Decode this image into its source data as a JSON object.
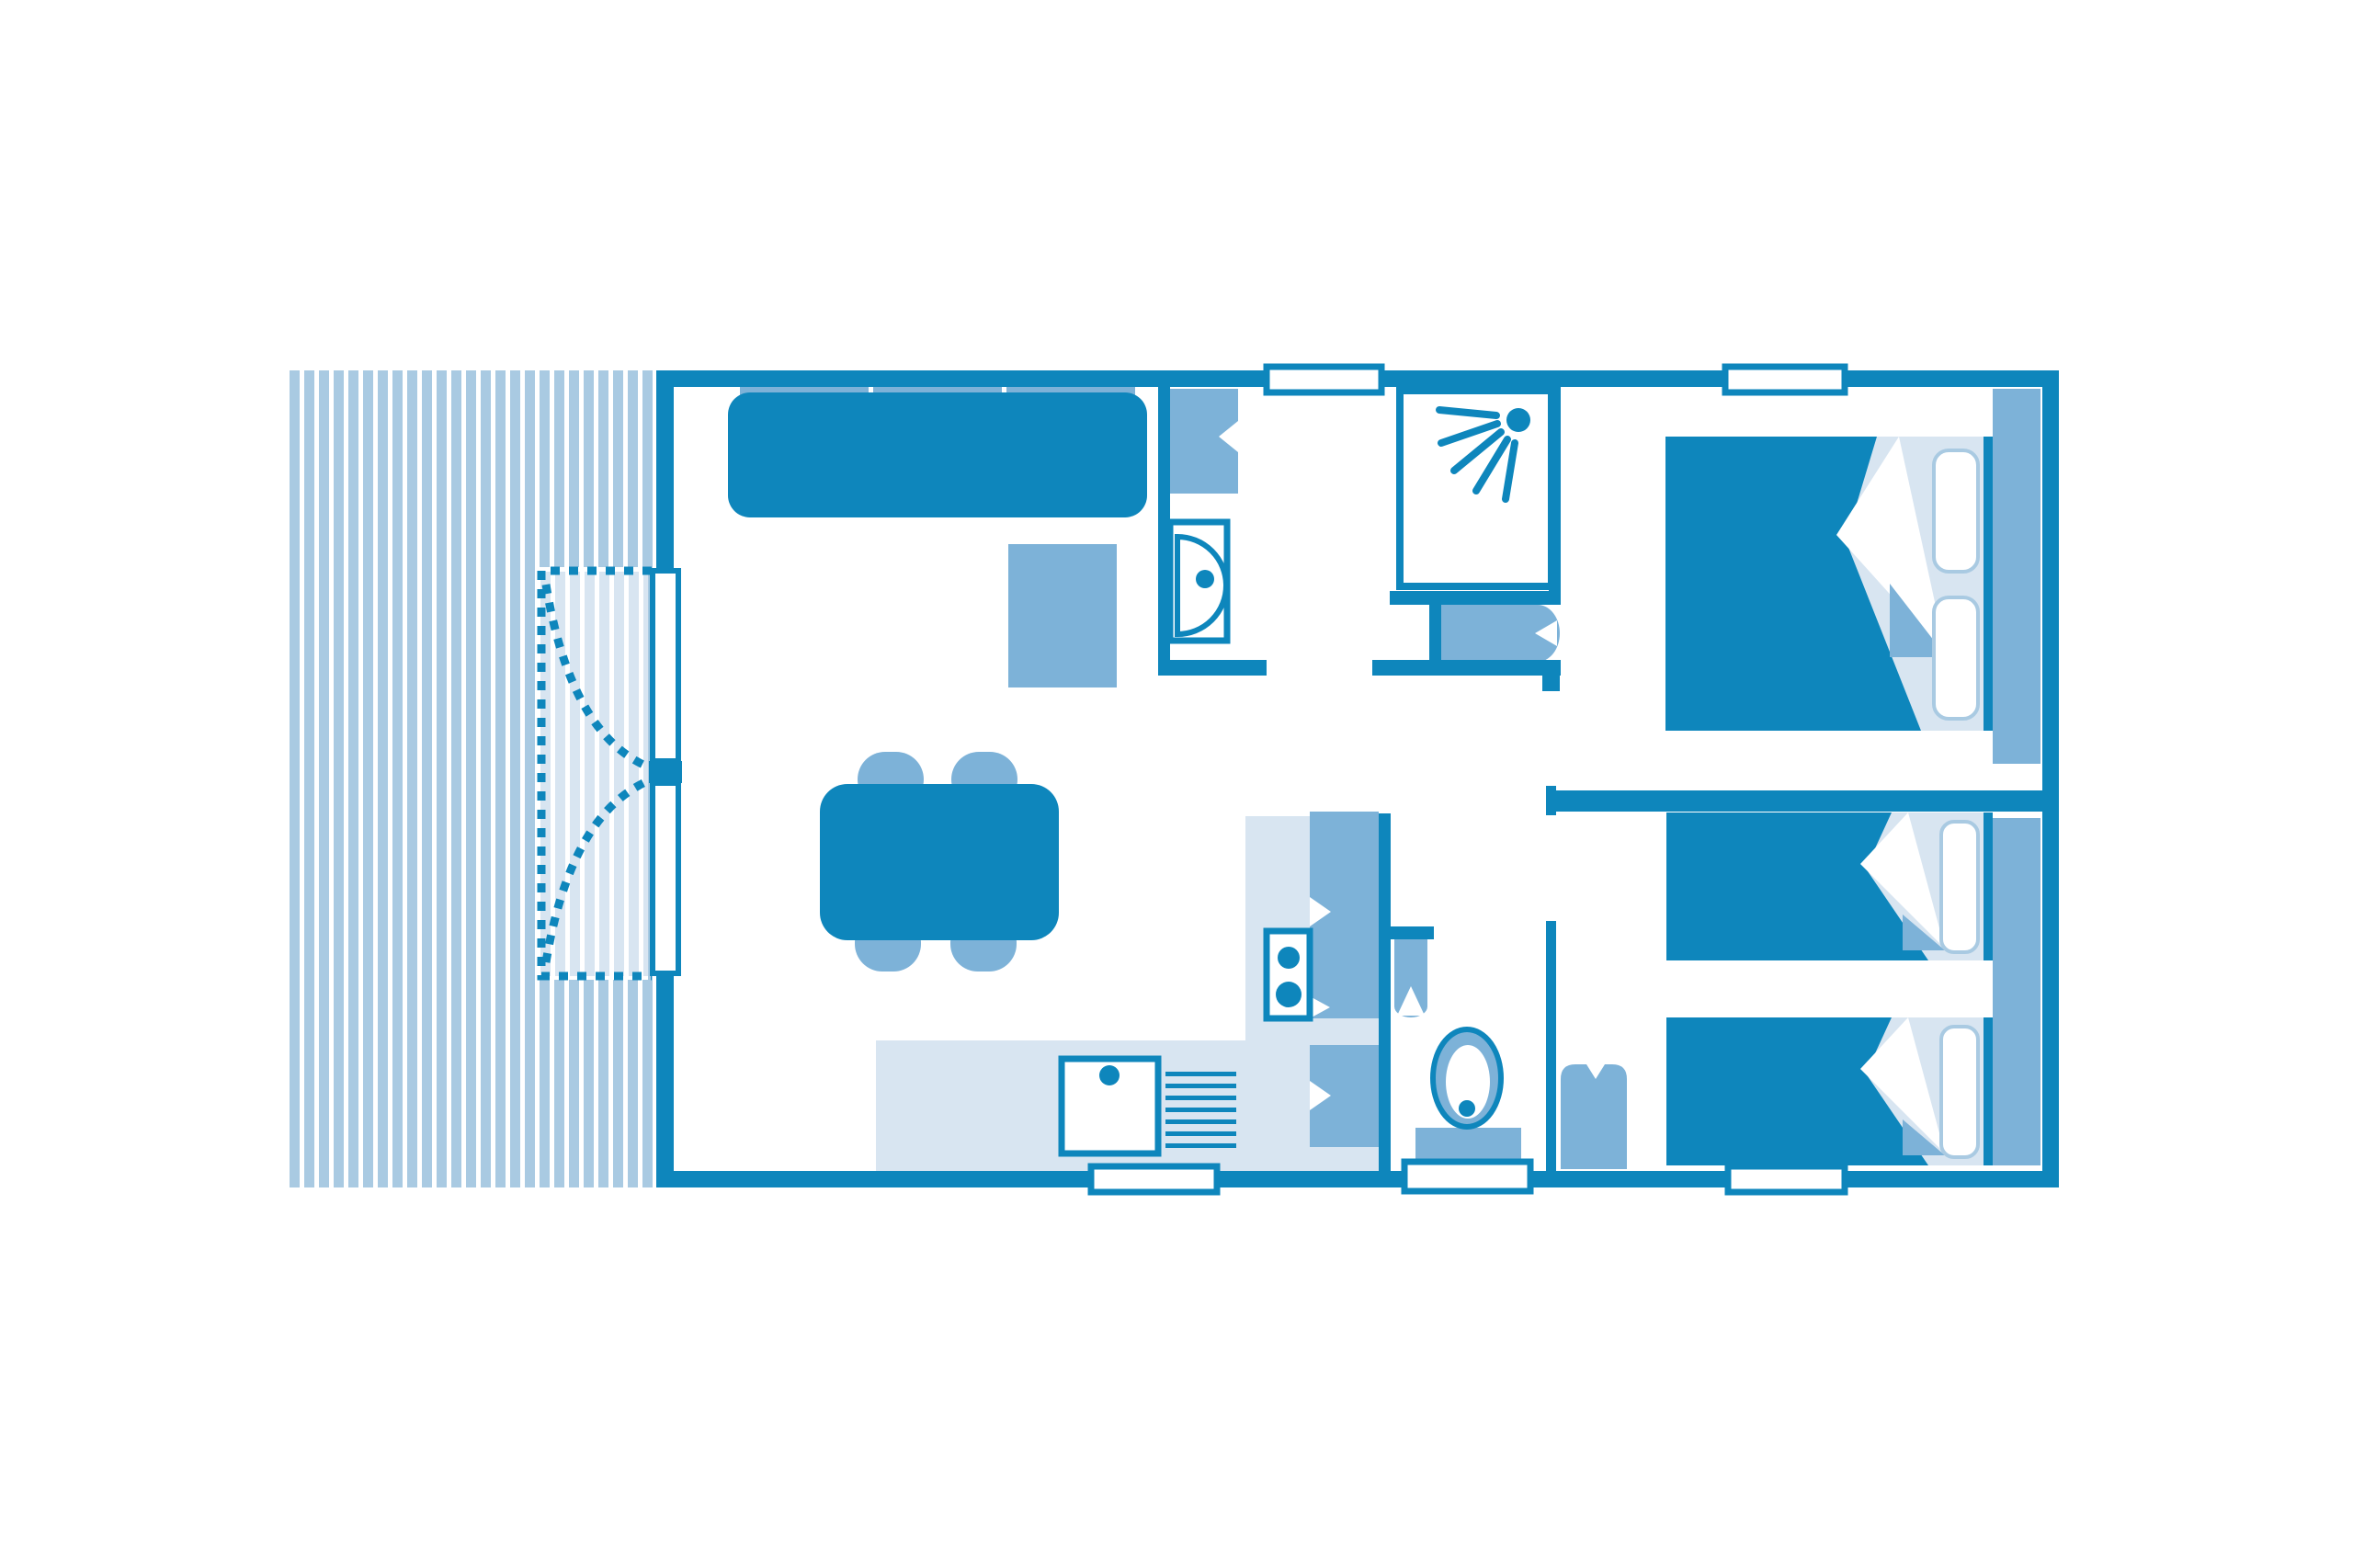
{
  "meta": {
    "type": "floor-plan-diagram",
    "description": "Blue monochrome top-view floor plan of a mobile home with striped terrace, living area, kitchen, bathroom, WC and two bedrooms",
    "text_on_image": ""
  },
  "colors": {
    "wall": "#0e86bc",
    "dark": "#0e86bc",
    "medium": "#7db2d8",
    "light": "#a9cae2",
    "pale": "#d8e5f1",
    "white": "#ffffff"
  },
  "rooms": [
    {
      "name": "terrace",
      "elements": [
        "decking-stripes",
        "curtain-area-dashed",
        "curtain-sweep-left",
        "curtain-sweep-right",
        "sliding-door-two-panels"
      ]
    },
    {
      "name": "living-area",
      "elements": [
        "sofa-three-cushions",
        "side-table",
        "dining-table",
        "chair x4"
      ]
    },
    {
      "name": "kitchen",
      "elements": [
        "l-shaped-counter",
        "sink-with-faucet",
        "drainer-7-grooves",
        "hob-2-burners",
        "fridge-cabinet",
        "lower-cabinet",
        "window-bottom"
      ]
    },
    {
      "name": "bathroom",
      "elements": [
        "storage-cabinet",
        "washbasin-with-faucet",
        "shower-cabin-with-spray-head-5-jets",
        "under-shower-cabinet",
        "window-top"
      ]
    },
    {
      "name": "wc",
      "elements": [
        "toilet",
        "small-wall-cabinet",
        "entrance-door-bottom"
      ]
    },
    {
      "name": "hallway",
      "elements": []
    },
    {
      "name": "bedroom-master",
      "elements": [
        "double-bed-with-folded-duvet",
        "two-pillows",
        "headboard",
        "window-top"
      ]
    },
    {
      "name": "bedroom-twin",
      "elements": [
        "single-bed-upper",
        "single-bed-lower",
        "pillows",
        "headboard",
        "water-heater-cylinder",
        "window-bottom"
      ]
    }
  ],
  "counts": {
    "windows": 4,
    "exterior_doors": 2,
    "beds": 3,
    "dining_chairs": 4,
    "sofa_cushions": 3,
    "hob_burners": 2,
    "drainer_grooves": 7,
    "shower_jets": 5
  }
}
